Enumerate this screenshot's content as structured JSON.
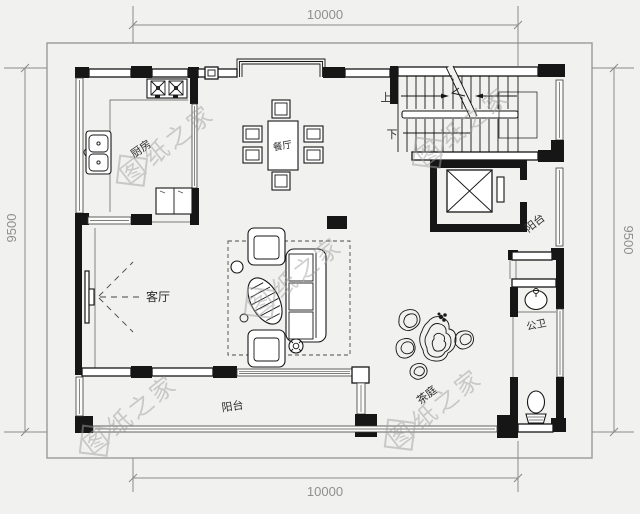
{
  "plan": {
    "dimensions": {
      "top": "10000",
      "bottom": "10000",
      "left": "9500",
      "right": "9500"
    },
    "rooms": {
      "kitchen": "厨房",
      "dining": "餐厅",
      "living": "客厅",
      "balcony_right": "阳台",
      "balcony_bottom": "阳台",
      "bathroom": "公卫",
      "tea_garden": "茶庭",
      "stair_up": "上",
      "stair_down": "下"
    },
    "watermark": "图纸之家",
    "watermark_first": "图",
    "watermark_rest": "纸之家",
    "colors": {
      "background": "#f1f1ef",
      "line": "#161616",
      "dim": "#8a8a8a",
      "watermark": "#a0a0a0"
    }
  }
}
